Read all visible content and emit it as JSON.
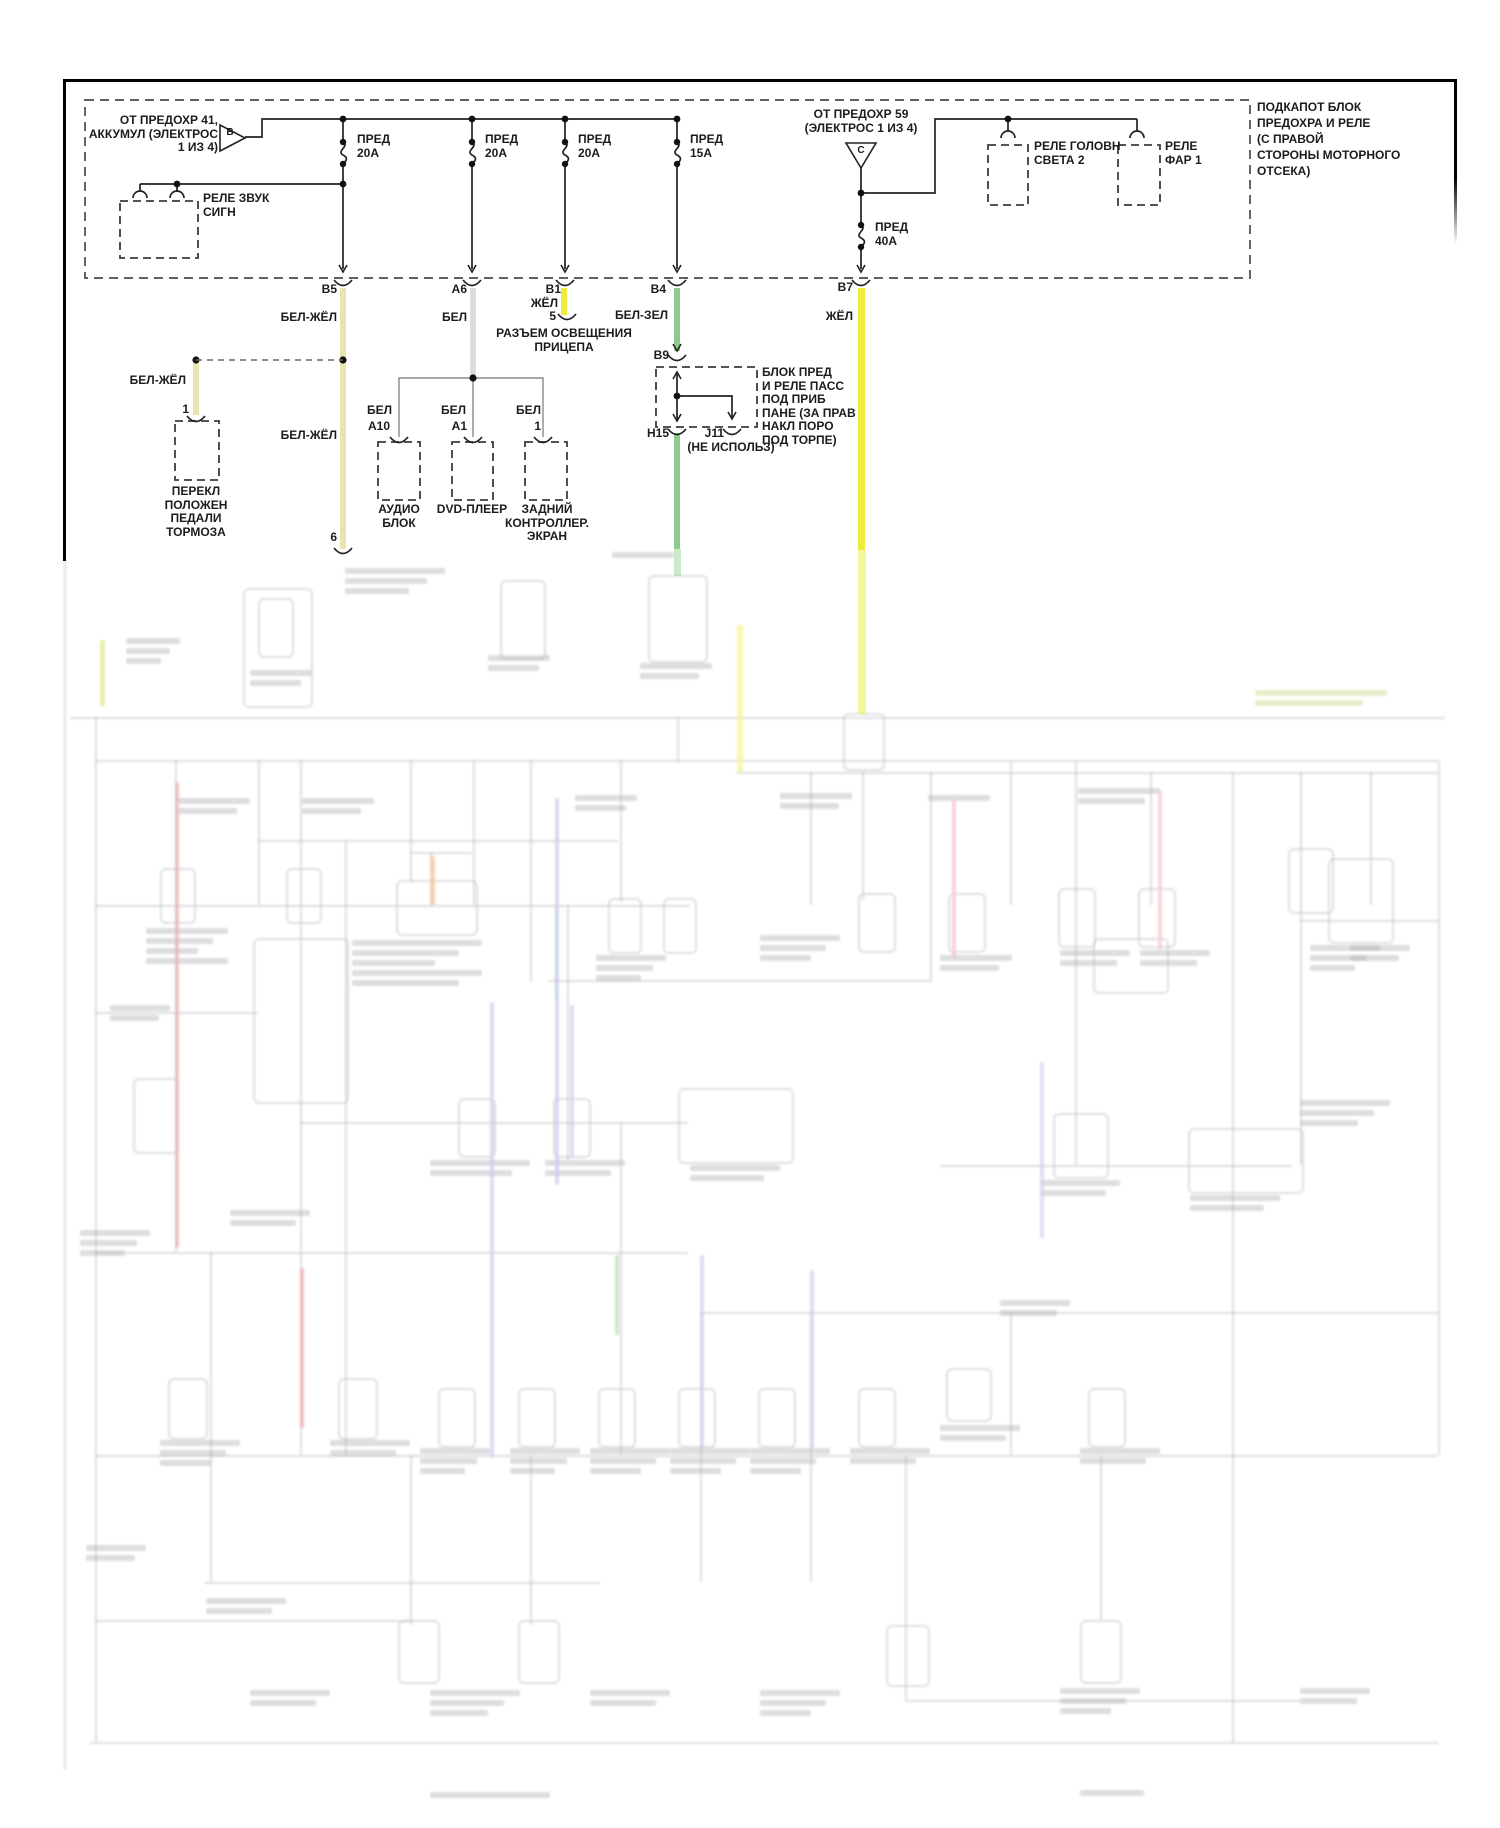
{
  "diagram": {
    "language": "ru",
    "type": "automotive-wiring-diagram",
    "colors": {
      "yellow": "#eeee3a",
      "pale_yellow": "#eae3b2",
      "green": "#8ccb8c",
      "white": "#dcdcdc",
      "line": "#222222"
    },
    "labels": [
      {
        "name": "from-fuse-41-label",
        "text": "ОТ ПРЕДОХР 41,\nАККУМУЛ (ЭЛЕКТРОС\n1 ИЗ 4)",
        "x": 78,
        "y": 114,
        "w": 140,
        "align": "right"
      },
      {
        "name": "triangle-b-letter",
        "text": "B",
        "x": 222,
        "y": 126,
        "w": 16,
        "align": "center",
        "size": 10
      },
      {
        "name": "fuse-20a-1-label",
        "text": "ПРЕД\n20А",
        "x": 357,
        "y": 133,
        "w": 60,
        "align": "left"
      },
      {
        "name": "fuse-20a-2-label",
        "text": "ПРЕД\n20А",
        "x": 485,
        "y": 133,
        "w": 60,
        "align": "left"
      },
      {
        "name": "fuse-20a-3-label",
        "text": "ПРЕД\n20А",
        "x": 578,
        "y": 133,
        "w": 60,
        "align": "left"
      },
      {
        "name": "fuse-15a-label",
        "text": "ПРЕД\n15А",
        "x": 690,
        "y": 133,
        "w": 60,
        "align": "left"
      },
      {
        "name": "horn-relay-label",
        "text": "РЕЛЕ ЗВУК\nСИГН",
        "x": 203,
        "y": 192,
        "w": 90,
        "align": "left"
      },
      {
        "name": "from-fuse-59-label",
        "text": "ОТ ПРЕДОХР 59\n(ЭЛЕКТРОС 1 ИЗ 4)",
        "x": 781,
        "y": 108,
        "w": 160,
        "align": "center"
      },
      {
        "name": "triangle-c-letter",
        "text": "C",
        "x": 853,
        "y": 144,
        "w": 16,
        "align": "center",
        "size": 10
      },
      {
        "name": "fuse-40a-label",
        "text": "ПРЕД\n40А",
        "x": 875,
        "y": 221,
        "w": 60,
        "align": "left"
      },
      {
        "name": "headlight-relay-2-label",
        "text": "РЕЛЕ ГОЛОВН\nСВЕТА 2",
        "x": 1034,
        "y": 140,
        "w": 110,
        "align": "left"
      },
      {
        "name": "headlamp-relay-1-label",
        "text": "РЕЛЕ\nФАР 1",
        "x": 1165,
        "y": 140,
        "w": 70,
        "align": "left"
      },
      {
        "name": "underhood-block-label",
        "text": "ПОДКАПОТ БЛОК\nПРЕДОХРА И РЕЛЕ\n(С ПРАВОЙ\nСТОРОНЫ МОТОРНОГО\nОТСЕКА)",
        "x": 1257,
        "y": 99,
        "w": 175,
        "align": "left",
        "lh": 16
      },
      {
        "name": "pin-b5-label",
        "text": "B5",
        "x": 297,
        "y": 283,
        "w": 40,
        "align": "right"
      },
      {
        "name": "wire-color-b5-label",
        "text": "БЕЛ-ЖЁЛ",
        "x": 237,
        "y": 311,
        "w": 100,
        "align": "right"
      },
      {
        "name": "pin-a6-label",
        "text": "A6",
        "x": 427,
        "y": 283,
        "w": 40,
        "align": "right"
      },
      {
        "name": "wire-color-a6-label",
        "text": "БЕЛ",
        "x": 387,
        "y": 311,
        "w": 80,
        "align": "right"
      },
      {
        "name": "pin-b1-label",
        "text": "B1",
        "x": 521,
        "y": 283,
        "w": 40,
        "align": "right"
      },
      {
        "name": "wire-color-b1-label",
        "text": "ЖЁЛ",
        "x": 478,
        "y": 297,
        "w": 80,
        "align": "right"
      },
      {
        "name": "pin-5-label",
        "text": "5",
        "x": 516,
        "y": 310,
        "w": 40,
        "align": "right"
      },
      {
        "name": "trailer-connector-label",
        "text": "РАЗЪЕМ ОСВЕЩЕНИЯ\nПРИЦЕПА",
        "x": 484,
        "y": 327,
        "w": 160,
        "align": "center"
      },
      {
        "name": "pin-b4-label",
        "text": "B4",
        "x": 626,
        "y": 283,
        "w": 40,
        "align": "right"
      },
      {
        "name": "wire-color-b4-label",
        "text": "БЕЛ-ЗЕЛ",
        "x": 568,
        "y": 309,
        "w": 100,
        "align": "right"
      },
      {
        "name": "pin-b7-label",
        "text": "B7",
        "x": 813,
        "y": 281,
        "w": 40,
        "align": "right"
      },
      {
        "name": "wire-color-b7-label",
        "text": "ЖЁЛ",
        "x": 773,
        "y": 310,
        "w": 80,
        "align": "right"
      },
      {
        "name": "wire-color-pedal-label",
        "text": "БЕЛ-ЖЁЛ",
        "x": 86,
        "y": 374,
        "w": 100,
        "align": "right"
      },
      {
        "name": "pin-1-pedal-label",
        "text": "1",
        "x": 149,
        "y": 403,
        "w": 40,
        "align": "right"
      },
      {
        "name": "wire-color-b5-lower-label",
        "text": "БЕЛ-ЖЁЛ",
        "x": 237,
        "y": 429,
        "w": 100,
        "align": "right"
      },
      {
        "name": "pedal-switch-label",
        "text": "ПЕРЕКЛ\nПОЛОЖЕН\nПЕДАЛИ\nТОРМОЗА",
        "x": 141,
        "y": 485,
        "w": 110,
        "align": "center"
      },
      {
        "name": "pin-b9-label",
        "text": "B9",
        "x": 629,
        "y": 349,
        "w": 40,
        "align": "right"
      },
      {
        "name": "passenger-fuse-block-label",
        "text": "БЛОК ПРЕД\nИ РЕЛЕ ПАСС\nПОД ПРИБ\nПАНЕ (ЗА ПРАВ\nНАКЛ ПОРО\nПОД ТОРПЕ)",
        "x": 762,
        "y": 366,
        "w": 110,
        "align": "left"
      },
      {
        "name": "pin-h15-label",
        "text": "H15",
        "x": 629,
        "y": 427,
        "w": 40,
        "align": "right"
      },
      {
        "name": "pin-j11-label",
        "text": "J11",
        "x": 684,
        "y": 427,
        "w": 40,
        "align": "right"
      },
      {
        "name": "not-used-label",
        "text": "(НЕ ИСПОЛЬЗ)",
        "x": 671,
        "y": 441,
        "w": 120,
        "align": "center"
      },
      {
        "name": "wire-color-a10-label",
        "text": "БЕЛ",
        "x": 352,
        "y": 404,
        "w": 40,
        "align": "right"
      },
      {
        "name": "pin-a10-label",
        "text": "A10",
        "x": 350,
        "y": 420,
        "w": 40,
        "align": "right"
      },
      {
        "name": "wire-color-a1-label",
        "text": "БЕЛ",
        "x": 426,
        "y": 404,
        "w": 40,
        "align": "right"
      },
      {
        "name": "pin-a1-label",
        "text": "A1",
        "x": 427,
        "y": 420,
        "w": 40,
        "align": "right"
      },
      {
        "name": "wire-color-rear-label",
        "text": "БЕЛ",
        "x": 501,
        "y": 404,
        "w": 40,
        "align": "right"
      },
      {
        "name": "pin-1-rear-label",
        "text": "1",
        "x": 501,
        "y": 420,
        "w": 40,
        "align": "right"
      },
      {
        "name": "audio-unit-label",
        "text": "АУДИО\nБЛОК",
        "x": 359,
        "y": 503,
        "w": 80,
        "align": "center"
      },
      {
        "name": "dvd-player-label",
        "text": "DVD-ПЛЕЕР",
        "x": 427,
        "y": 503,
        "w": 90,
        "align": "center"
      },
      {
        "name": "rear-controller-label",
        "text": "ЗАДНИЙ\nКОНТРОЛЛЕР.\nЭКРАН",
        "x": 497,
        "y": 503,
        "w": 100,
        "align": "center"
      },
      {
        "name": "pin-6-label",
        "text": "6",
        "x": 297,
        "y": 531,
        "w": 40,
        "align": "right"
      }
    ],
    "wires": [
      {
        "name": "wire-b5-beljol",
        "color": "pale_yellow",
        "x": 340,
        "y": 288,
        "h": 261,
        "w": 6
      },
      {
        "name": "wire-a6-bel",
        "color": "white",
        "x": 470,
        "y": 288,
        "h": 90,
        "w": 6
      },
      {
        "name": "wire-b1-jol",
        "color": "yellow",
        "x": 561,
        "y": 288,
        "h": 27,
        "w": 6
      },
      {
        "name": "wire-b4-belzel",
        "color": "green",
        "x": 674,
        "y": 288,
        "h": 63,
        "w": 6
      },
      {
        "name": "wire-b7-jol",
        "color": "yellow",
        "x": 858,
        "y": 288,
        "h": 262,
        "w": 7
      },
      {
        "name": "wire-b7-jol-faded",
        "color": "yellow",
        "x": 858,
        "y": 550,
        "h": 164,
        "w": 8,
        "opacity": 0.5
      },
      {
        "name": "wire-h15-belzel",
        "color": "green",
        "x": 674,
        "y": 433,
        "h": 116,
        "w": 6
      },
      {
        "name": "wire-h15-belzel-faded",
        "color": "green",
        "x": 674,
        "y": 549,
        "h": 27,
        "w": 7,
        "opacity": 0.45
      },
      {
        "name": "wire-pedal-beljol",
        "color": "pale_yellow",
        "x": 193,
        "y": 362,
        "h": 53,
        "w": 6
      }
    ]
  }
}
